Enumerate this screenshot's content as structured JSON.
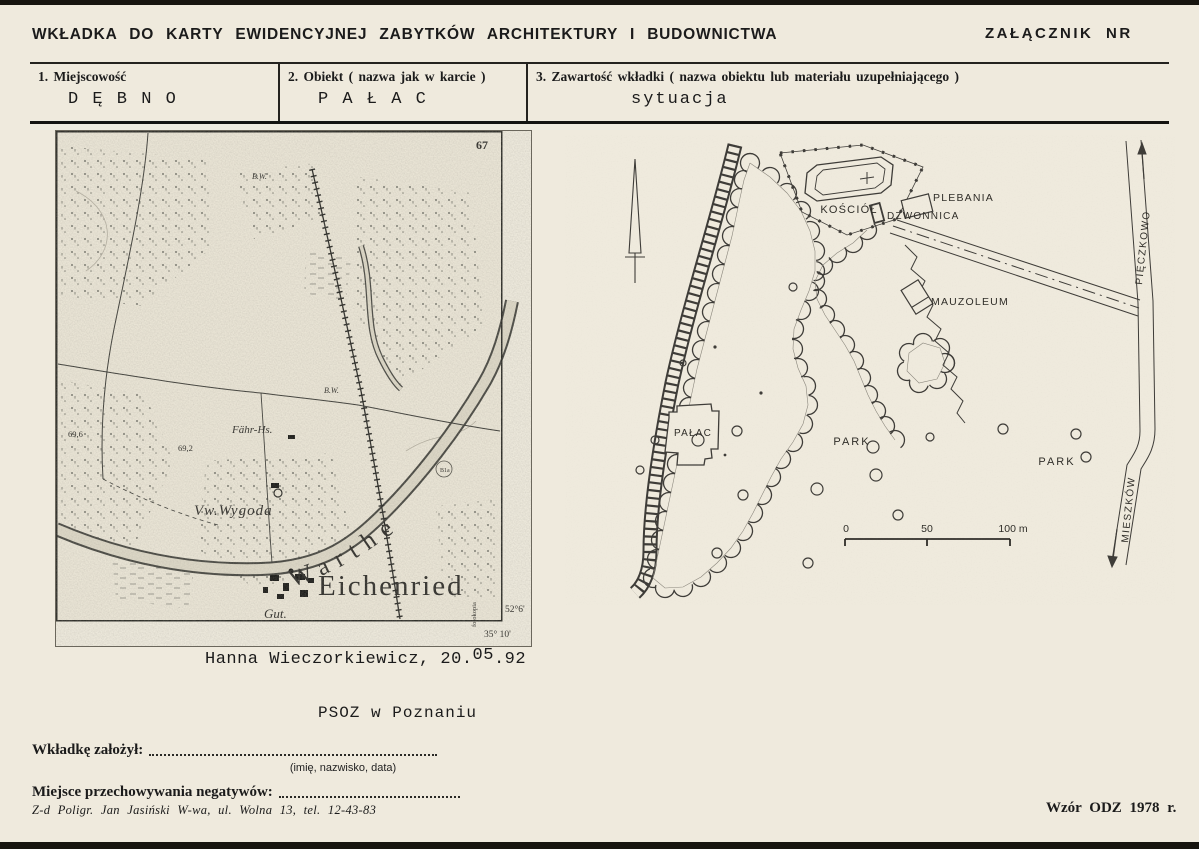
{
  "header": {
    "title": "WKŁADKA DO KARTY EWIDENCYJNEJ ZABYTKÓW ARCHITEKTURY I BUDOWNICTWA",
    "annex_label": "ZAŁĄCZNIK NR"
  },
  "fields": [
    {
      "label": "1. Miejscowość",
      "value": "D Ę B N O"
    },
    {
      "label": "2. Obiekt ( nazwa jak w karcie )",
      "value": "P A Ł A C"
    },
    {
      "label": "3. Zawartość wkładki ( nazwa obiektu lub materiału uzupełniającego )",
      "value": "sytuacja"
    }
  ],
  "map": {
    "sheet_number": "67",
    "place_label": "Eichenried",
    "river_label": "Warthe",
    "farm_label": "Vw.Wygoda",
    "estate_label": "Gut.",
    "ferry_label": "Fähr-Hs.",
    "elevation_1": "69,6",
    "elevation_2": "69,2",
    "mark_1": "B.W.",
    "mark_2": "B.W.",
    "ring_mark": "B1a",
    "latitude": "52°6'",
    "longitude": "35° 10'",
    "margin_note": "fotokopia"
  },
  "site_plan": {
    "church_label": "KOŚCIÓŁ",
    "belfry_label": "DZWONNICA",
    "rectory_label": "PLEBANIA",
    "mausoleum_label": "MAUZOLEUM",
    "palace_label": "PAŁAC",
    "park_label_1": "PARK",
    "park_label_2": "PARK",
    "road_north_label": "PIĘCZKOWO",
    "road_south_label": "MIESZKÓW",
    "scale": {
      "zero": "0",
      "fifty": "50",
      "hundred": "100 m"
    }
  },
  "annotations": {
    "author_prefix": "Hanna Wieczorkiewicz, 20.",
    "author_month": "05",
    "author_suffix": ".92",
    "institution": "PSOZ w Poznaniu"
  },
  "footer": {
    "founder_label": "Wkładkę założył:",
    "founder_hint": "(imię, nazwisko, data)",
    "negatives_label": "Miejsce przechowywania negatywów:",
    "printer_line": "Z-d Poligr. Jan Jasiński W-wa, ul. Wolna 13, tel. 12-43-83",
    "form_code": "Wzór ODZ 1978 r."
  }
}
